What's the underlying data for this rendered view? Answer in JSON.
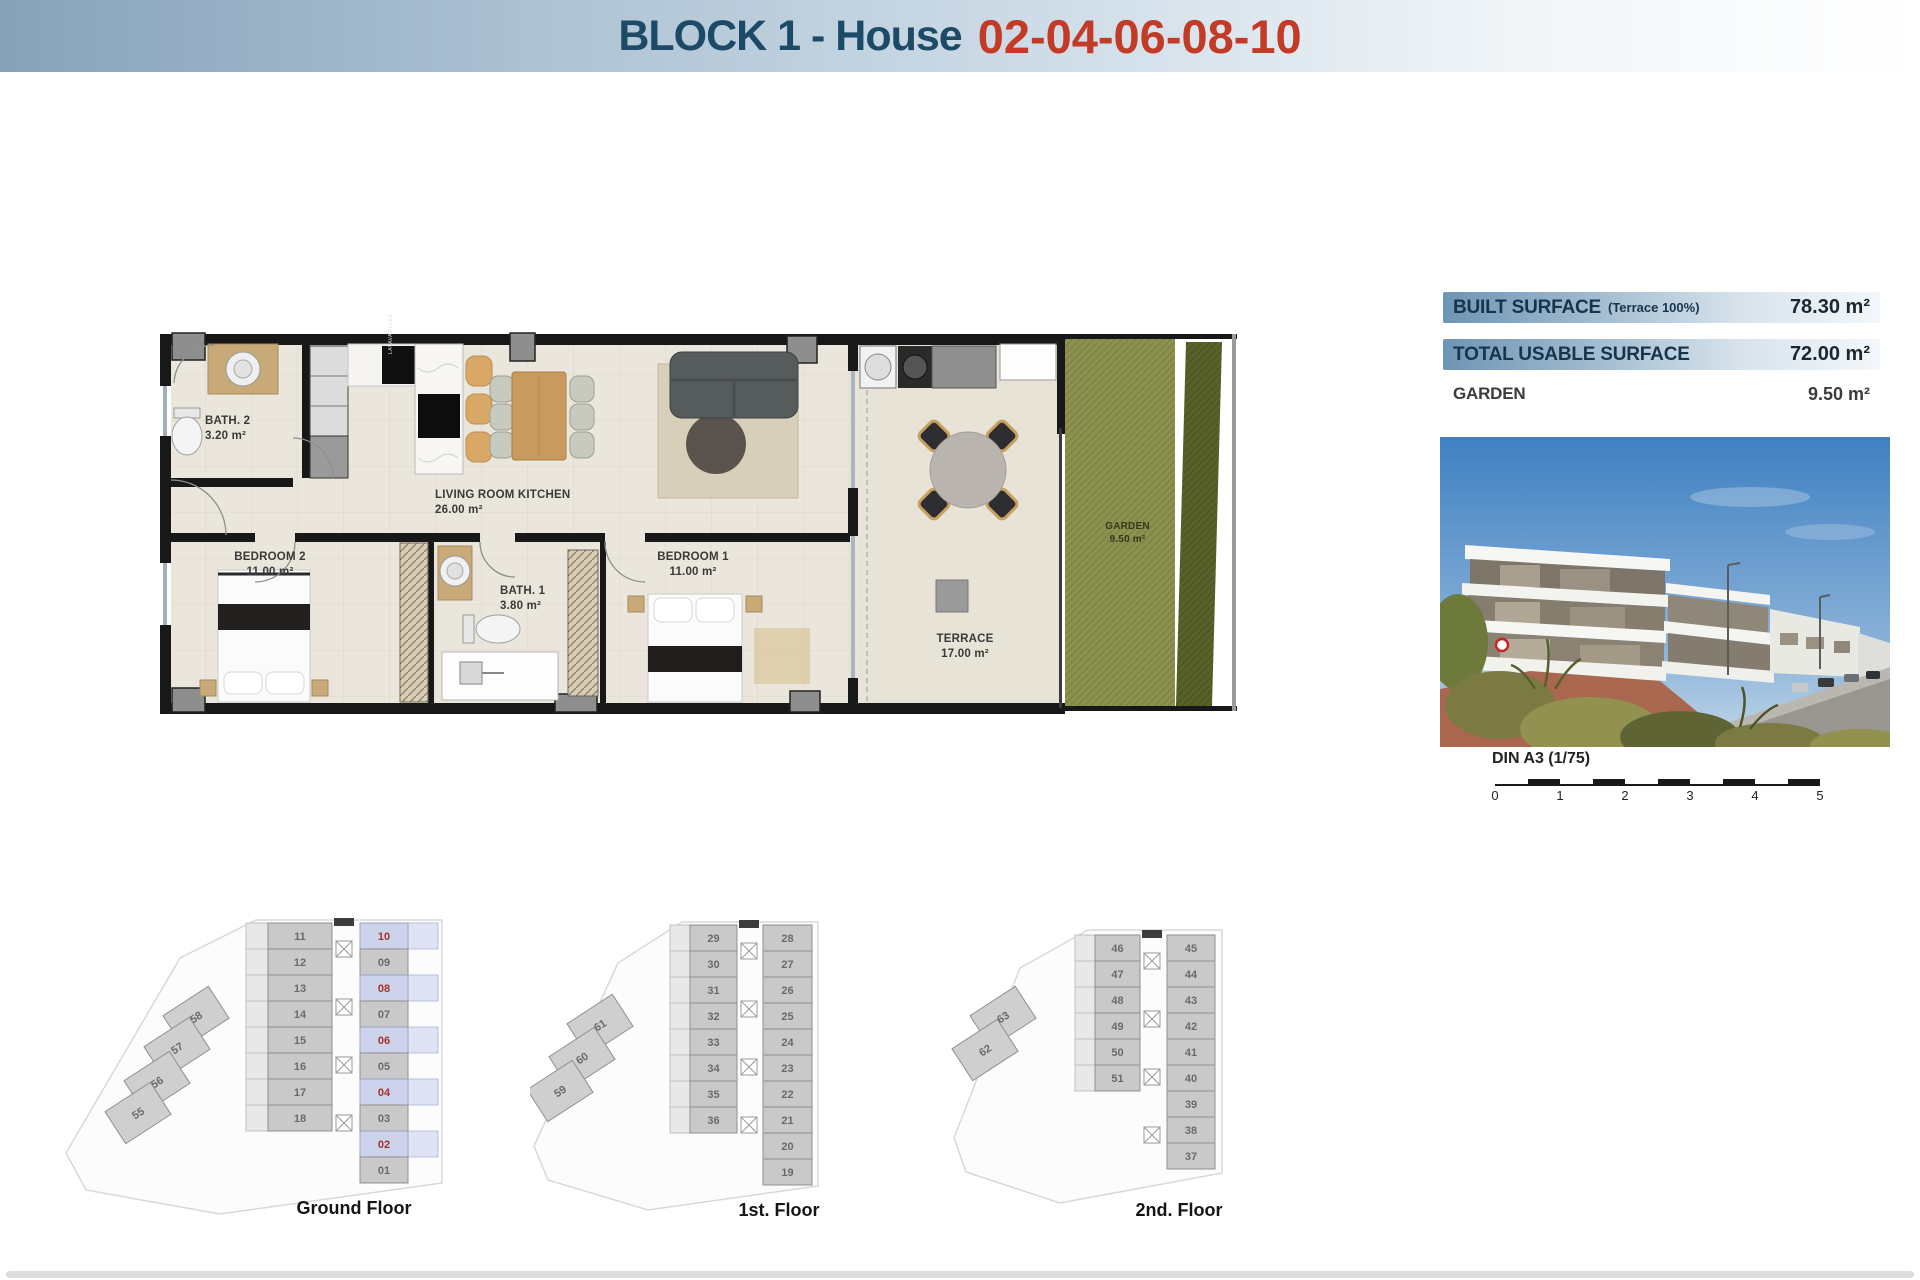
{
  "header": {
    "title_block": "BLOCK 1 - House",
    "title_numbers": "02-04-06-08-10"
  },
  "floor_plan": {
    "kitchen_label": "LAVAVAJILLAS",
    "rooms": [
      {
        "id": "bath2",
        "name": "BATH. 2",
        "area": "3.20 m²"
      },
      {
        "id": "living",
        "name": "LIVING ROOM KITCHEN",
        "area": "26.00 m²"
      },
      {
        "id": "bedroom2",
        "name": "BEDROOM 2",
        "area": "11.00 m²"
      },
      {
        "id": "bath1",
        "name": "BATH. 1",
        "area": "3.80 m²"
      },
      {
        "id": "bedroom1",
        "name": "BEDROOM 1",
        "area": "11.00 m²"
      },
      {
        "id": "terrace",
        "name": "TERRACE",
        "area": "17.00 m²"
      },
      {
        "id": "garden",
        "name": "GARDEN",
        "area": "9.50 m²"
      }
    ]
  },
  "surface_panel": {
    "rows": [
      {
        "label": "BUILT SURFACE",
        "note": "(Terrace 100%)",
        "value": "78.30 m²"
      },
      {
        "label": "TOTAL USABLE SURFACE",
        "note": "",
        "value": "72.00 m²"
      },
      {
        "label": "GARDEN",
        "note": "",
        "value": "9.50 m²"
      }
    ]
  },
  "scale_bar": {
    "label": "DIN A3 (1/75)",
    "ticks": [
      "0",
      "1",
      "2",
      "3",
      "4",
      "5"
    ]
  },
  "floors": [
    {
      "id": "ground-floor",
      "label": "Ground Floor",
      "left_units": [
        "11",
        "12",
        "13",
        "14",
        "15",
        "16",
        "17",
        "18"
      ],
      "right_units": [
        {
          "n": "10",
          "hl": true
        },
        {
          "n": "09",
          "hl": false
        },
        {
          "n": "08",
          "hl": true
        },
        {
          "n": "07",
          "hl": false
        },
        {
          "n": "06",
          "hl": true
        },
        {
          "n": "05",
          "hl": false
        },
        {
          "n": "04",
          "hl": true
        },
        {
          "n": "03",
          "hl": false
        },
        {
          "n": "02",
          "hl": true
        },
        {
          "n": "01",
          "hl": false
        }
      ],
      "diag_units": [
        "58",
        "57",
        "56",
        "55"
      ]
    },
    {
      "id": "first-floor",
      "label": "1st. Floor",
      "left_units": [
        "29",
        "30",
        "31",
        "32",
        "33",
        "34",
        "35",
        "36"
      ],
      "right_units": [
        {
          "n": "28",
          "hl": false
        },
        {
          "n": "27",
          "hl": false
        },
        {
          "n": "26",
          "hl": false
        },
        {
          "n": "25",
          "hl": false
        },
        {
          "n": "24",
          "hl": false
        },
        {
          "n": "23",
          "hl": false
        },
        {
          "n": "22",
          "hl": false
        },
        {
          "n": "21",
          "hl": false
        },
        {
          "n": "20",
          "hl": false
        },
        {
          "n": "19",
          "hl": false
        }
      ],
      "diag_units": [
        "61",
        "60",
        "59"
      ]
    },
    {
      "id": "second-floor",
      "label": "2nd. Floor",
      "left_units": [
        "46",
        "47",
        "48",
        "49",
        "50",
        "51"
      ],
      "right_units": [
        {
          "n": "45",
          "hl": false
        },
        {
          "n": "44",
          "hl": false
        },
        {
          "n": "43",
          "hl": false
        },
        {
          "n": "42",
          "hl": false
        },
        {
          "n": "41",
          "hl": false
        },
        {
          "n": "40",
          "hl": false
        },
        {
          "n": "39",
          "hl": false
        },
        {
          "n": "38",
          "hl": false
        },
        {
          "n": "37",
          "hl": false
        }
      ],
      "diag_units": [
        "63",
        "62"
      ]
    }
  ],
  "colors": {
    "header_navy": "#1d4a66",
    "header_red": "#c23b26",
    "highlight_fill": "#ccd3ea",
    "highlight_text": "#a5322a",
    "garden_green": "#8d9150",
    "wall_black": "#181818"
  }
}
